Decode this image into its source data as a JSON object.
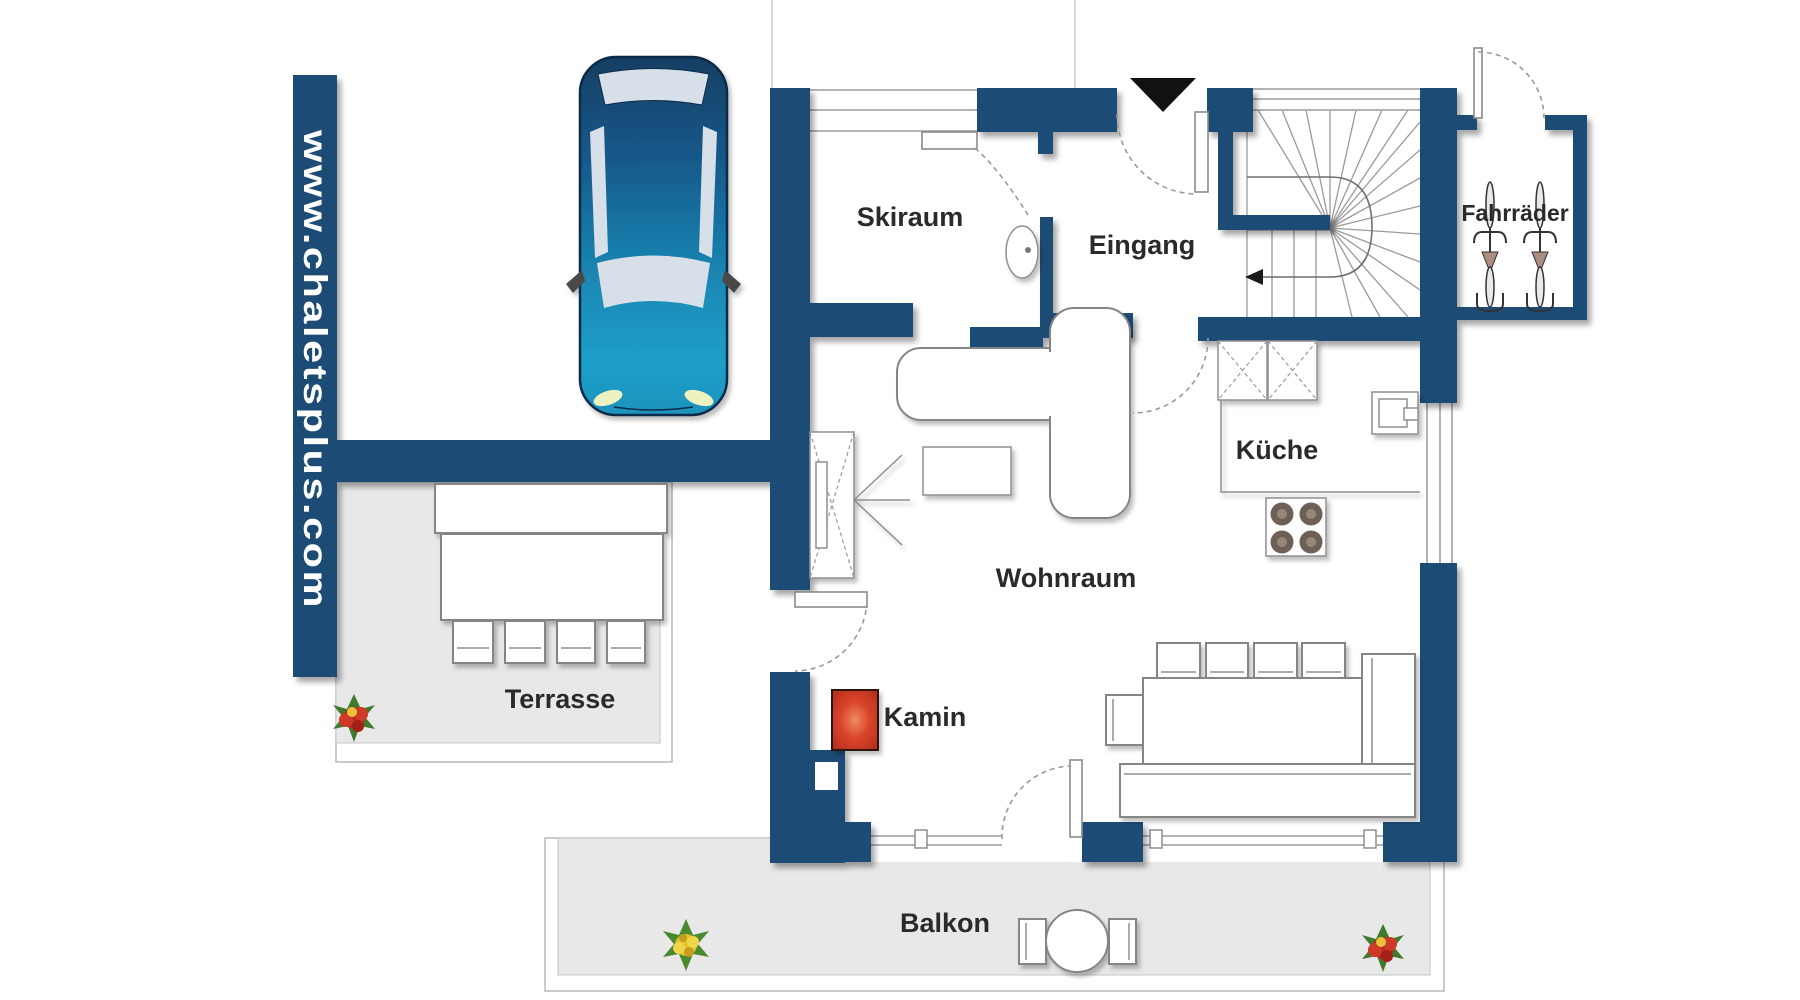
{
  "title": "Chalet floor plan - ground level",
  "watermark": "www.chaletsplus.com",
  "rooms": {
    "skiraum": "Skiraum",
    "eingang": "Eingang",
    "kueche": "Küche",
    "wohnraum": "Wohnraum",
    "kamin": "Kamin",
    "terrasse": "Terrasse",
    "balkon": "Balkon",
    "fahrraeder": "Fahrräder"
  },
  "colors": {
    "wall": "#1a4b74",
    "floor_outdoor": "#e8e8e8",
    "fireplace": "#d9442b",
    "car_body": "#1c7fb0",
    "label_text": "#2a2a2a",
    "watermark_text": "#ffffff"
  }
}
